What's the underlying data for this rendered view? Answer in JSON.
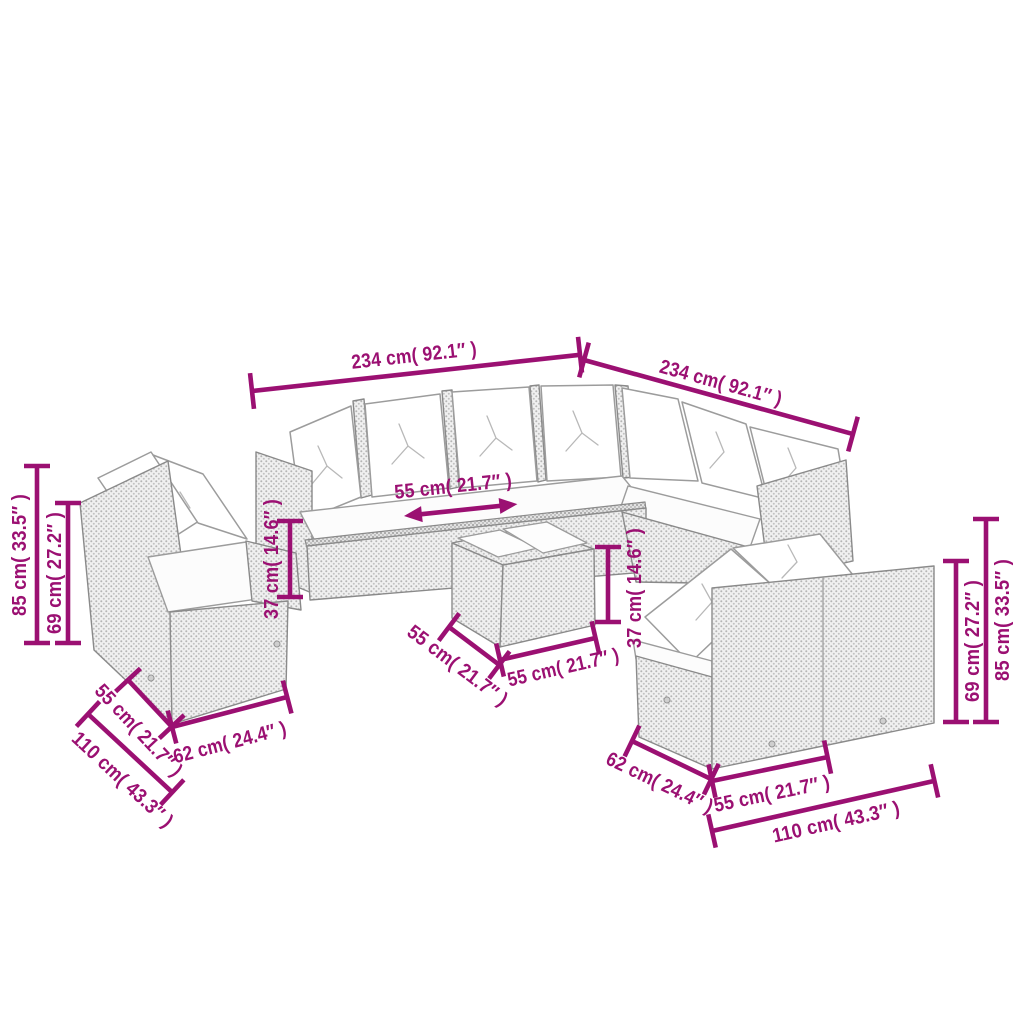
{
  "palette": {
    "background": "#ffffff",
    "dimension_color": "#9b1072",
    "furniture_outline": "#8a8a8a",
    "rattan_fill": "#f0f0f0",
    "rattan_dot": "#b5b5b5",
    "cushion_fill": "#ffffff"
  },
  "diagram_type": "product dimension diagram - rattan garden lounge set",
  "dimensions": {
    "sofa_top_left_width": "234 cm( 92.1″ )",
    "sofa_top_right_width": "234 cm( 92.1″ )",
    "sofa_seat_depth": "55 cm( 21.7″ )",
    "left_overall_height": "85 cm( 33.5″ )",
    "left_backrest_height": "69 cm( 27.2″ )",
    "left_seat_height": "37 cm( 14.6″ )",
    "right_seat_height": "37 cm( 14.6″ )",
    "right_backrest_height": "69 cm( 27.2″ )",
    "right_overall_height": "85 cm( 33.5″ )",
    "table_side_depth": "55 cm( 21.7″ )",
    "table_front_width": "55 cm( 21.7″ )",
    "left_bench_seat_width": "55 cm( 21.7″ )",
    "left_bench_depth": "62 cm( 24.4″ )",
    "left_bench_width": "110 cm( 43.3″ )",
    "right_bench_depth": "62 cm( 24.4″ )",
    "right_bench_seat_width": "55 cm( 21.7″ )",
    "right_bench_width": "110 cm( 43.3″ )"
  }
}
